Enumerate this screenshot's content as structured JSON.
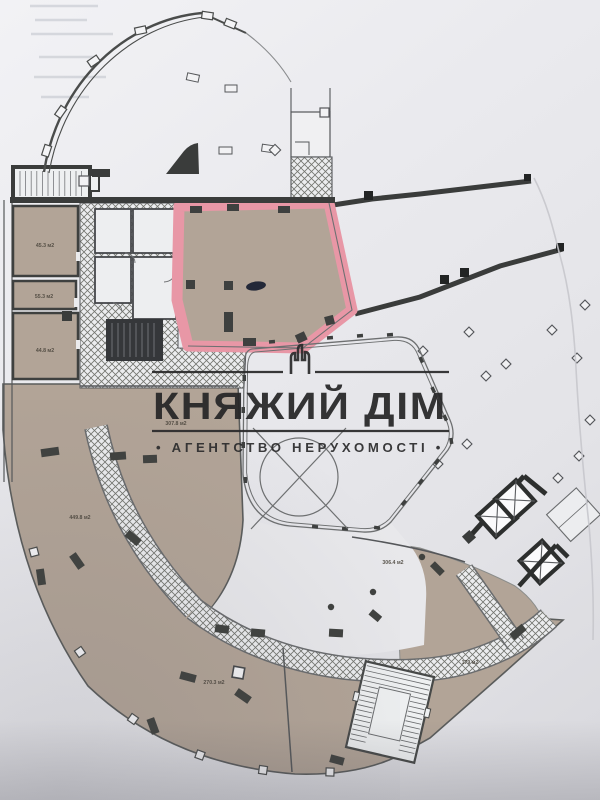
{
  "watermark": {
    "title": "КНЯЖИЙ ДІМ",
    "subtitle": "• АГЕНТСТВО НЕРУХОМОСТІ •"
  },
  "rooms": {
    "left_top": "45.3 м2",
    "left_middle": "55.3 м2",
    "left_bottom": "44.8 м2",
    "center_left": "307.8 м2",
    "bottom_left_hall": "449.8 м2",
    "bottom_center_hall": "270.3 м2",
    "bottom_right_hall": "306.4 м2",
    "right_wing": "179 м2"
  },
  "colors": {
    "highlight_pink": "#e897a6",
    "floor_tan": "#b2a497",
    "wall_dark": "#3a3c3b",
    "paper": "#e9e9ec",
    "hatch_line": "#73756f"
  }
}
